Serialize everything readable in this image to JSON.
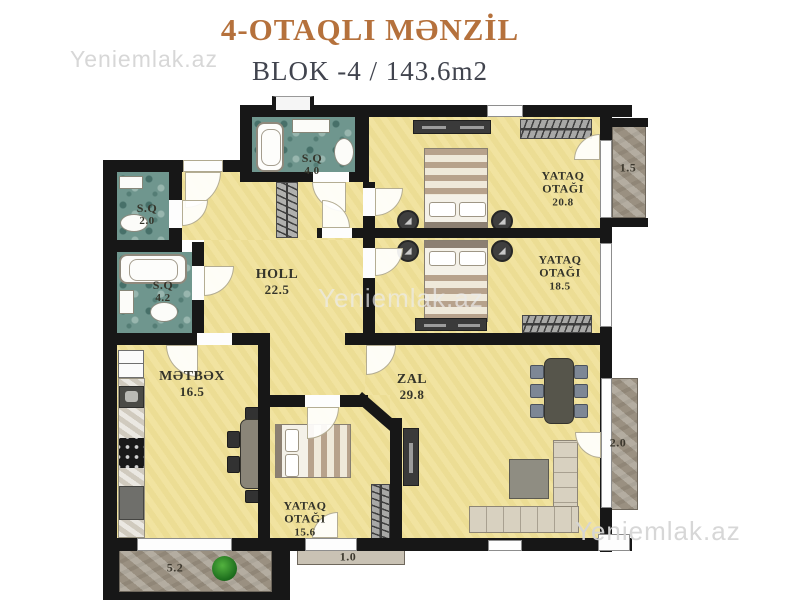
{
  "header": {
    "title": "4-OTAQLI MƏNZİL",
    "subtitle": "BLOK -4 / 143.6m2"
  },
  "watermark": {
    "text": "Yeniemlak.az"
  },
  "rooms": {
    "sq40": {
      "name": "S.Q",
      "area": "4.0"
    },
    "sq20": {
      "name": "S.Q",
      "area": "2.0"
    },
    "sq42": {
      "name": "S.Q",
      "area": "4.2"
    },
    "holl": {
      "name": "HOLL",
      "area": "22.5"
    },
    "bedroom1": {
      "name": "YATAQ OTAĞI",
      "area": "20.8"
    },
    "bedroom2": {
      "name": "YATAQ OTAĞI",
      "area": "18.5"
    },
    "bedroom3": {
      "name": "YATAQ OTAĞI",
      "area": "15.6"
    },
    "kitchen": {
      "name": "MƏTBƏX",
      "area": "16.5"
    },
    "zal": {
      "name": "ZAL",
      "area": "29.8"
    }
  },
  "balconies": {
    "top_right": {
      "area": "1.5"
    },
    "right": {
      "area": "2.0"
    },
    "bottom": {
      "area": "1.0"
    },
    "bottom_left": {
      "area": "5.2"
    }
  },
  "colors": {
    "title": "#b5713c",
    "subtitle": "#41444e",
    "floor": "#f0e199",
    "bathroom": "#6f968e",
    "balcony": "#a49b8c",
    "wall": "#171717",
    "watermark": "#d5d5d5"
  }
}
